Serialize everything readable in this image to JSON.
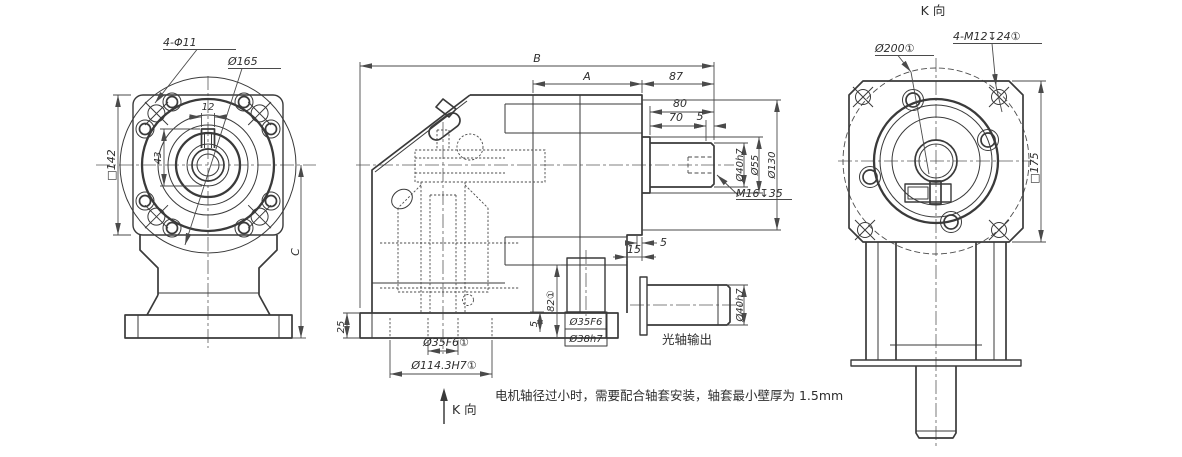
{
  "front_view": {
    "holes": "4-Φ11",
    "flange_circle": "Ø165",
    "square": "□142",
    "keyway_width": "12",
    "keyway_height": "43",
    "height": "C"
  },
  "side_view": {
    "total_length": "B",
    "mount_length": "A",
    "shaft_end_length": "87",
    "shaft_length": "80",
    "usable_length": "70",
    "tip_length": "5",
    "shaft_dia": "Ø40h7",
    "boss_dia": "Ø55",
    "register_dia": "Ø130",
    "tapped_hole": "M16↧35",
    "face_step": "5",
    "face_offset": "15",
    "base_height": "25",
    "pilot_depth": "82①",
    "pilot_step": "5",
    "input_bore": "Ø35F6①",
    "input_register": "Ø114.3H7①",
    "view_arrow": "K 向"
  },
  "sleeve_detail": {
    "inner_dia": "Ø35F6",
    "outer_dia": "Ø38h7"
  },
  "shaft_detail": {
    "dia": "Ø40h7",
    "caption": "光轴输出"
  },
  "k_view": {
    "title": "K 向",
    "register_dia": "Ø200①",
    "tapped_holes": "4-M12↧24①",
    "square": "□175"
  },
  "note": {
    "text": "电机轴径过小时，需要配合轴套安装，轴套最小壁厚为 1.5mm"
  }
}
